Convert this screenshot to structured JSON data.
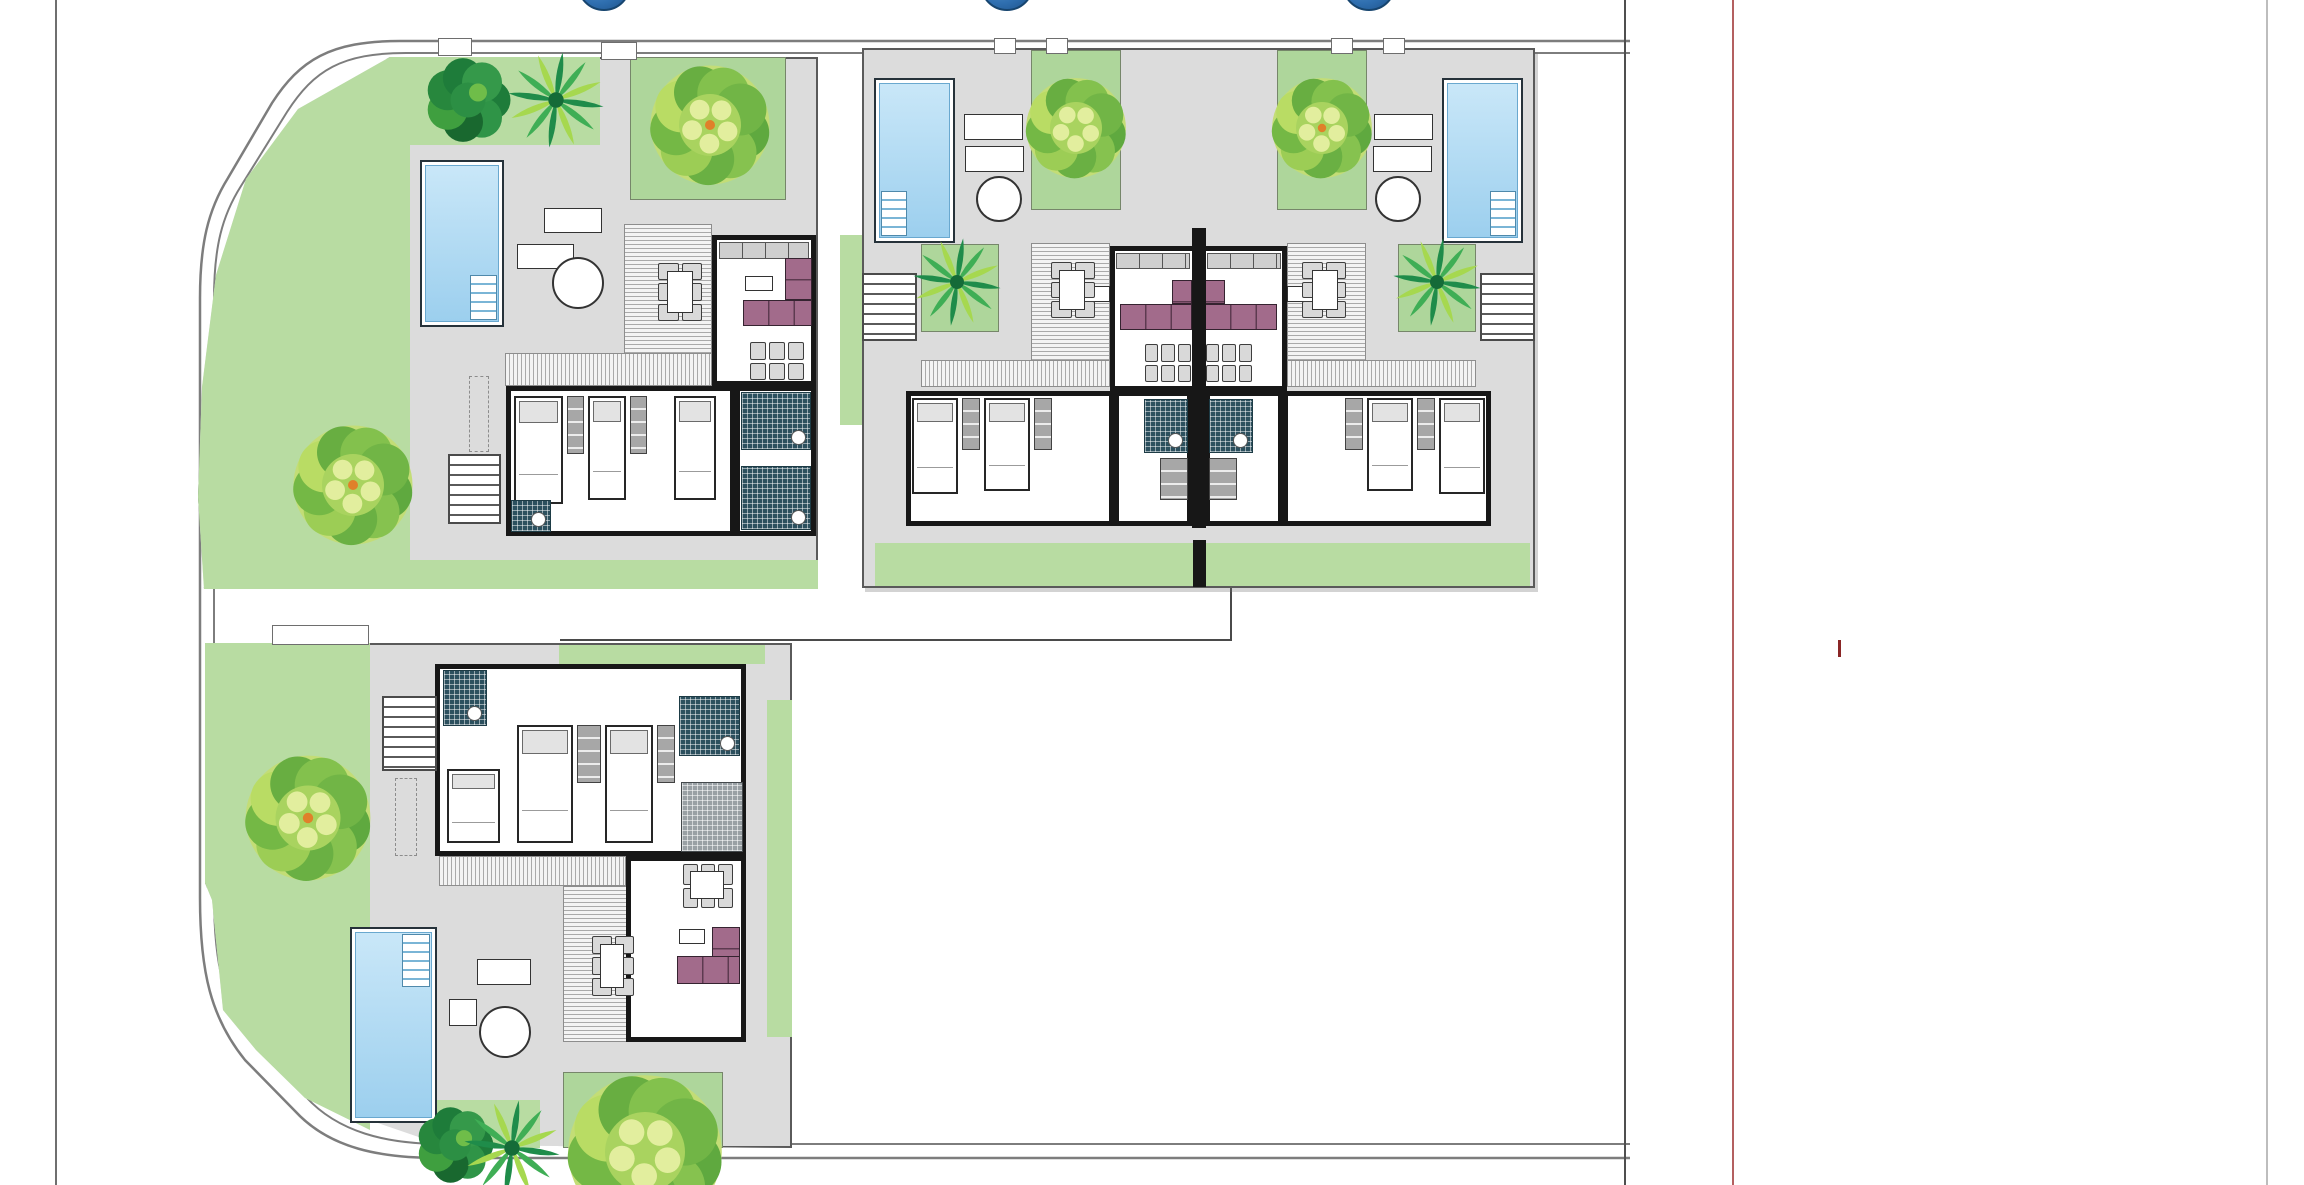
{
  "meta": {
    "kind": "residential-site-plan",
    "description": "Color site plan of four single-storey dwellings with private pools, gardens, trees and a curved perimeter road",
    "dwellings": [
      {
        "id": "villa-northwest",
        "bedrooms_visible": 3,
        "pool": true,
        "sun_loungers": 2,
        "outdoor_dining": true
      },
      {
        "id": "duplex-unit-west",
        "bedrooms_visible": 2,
        "pool": true,
        "sun_loungers": 2,
        "outdoor_dining": true
      },
      {
        "id": "duplex-unit-east",
        "bedrooms_visible": 2,
        "pool": true,
        "sun_loungers": 2,
        "outdoor_dining": true
      },
      {
        "id": "villa-south",
        "bedrooms_visible": 3,
        "pool": true,
        "sun_loungers": 1,
        "outdoor_dining": true
      }
    ]
  },
  "palette": {
    "paper": "#ffffff",
    "plotGray": "#dcdcdc",
    "plotBorder": "#5a5a5a",
    "lawn": "#b8dca2",
    "lawnB": "#aed69b",
    "pool": "#9ccfee",
    "poolLight": "#c9e7f8",
    "wall": "#171717",
    "sofa": "#a26b8b",
    "tile": "#2c505e",
    "road": "#7d7d7d",
    "marker": "#2f6fb0",
    "redline": "#b46060",
    "redtick": "#8a2626"
  },
  "road": {
    "outer": "M1630,41 H400 C330,41 300,60 272,103 L228,178 C208,210 200,244 200,298 V898 C200,972 211,1018 245,1060 L295,1111 C330,1149 381,1158 440,1158 H1630",
    "inner": "M1630,53 H406 C342,53 314,70 287,112 L241,186 C222,216 214,247 214,299 V896 C214,966 224,1008 257,1049 L306,1097 C338,1132 386,1144 442,1144 H1630"
  },
  "frame_lines": [
    {
      "n": "page-edge-left",
      "x": 55,
      "w": 2,
      "c": "#6f6f6f"
    },
    {
      "n": "parcel-line",
      "x": 1624,
      "w": 2,
      "c": "#4f4f4f"
    },
    {
      "n": "red-boundary-line",
      "x": 1732,
      "w": 2,
      "c": "#b46060"
    },
    {
      "n": "page-edge-right",
      "x": 2266,
      "w": 2,
      "c": "#bdbdbd"
    }
  ],
  "red_tick": {
    "x": 1838,
    "y": 640,
    "w": 3,
    "h": 17,
    "c": "#8a2626"
  },
  "markers": {
    "r": 27,
    "cy": -16,
    "items": [
      {
        "x": 604
      },
      {
        "x": 1007
      },
      {
        "x": 1369
      }
    ]
  },
  "plots": [
    {
      "n": "plot-northwest",
      "x": 198,
      "y": 57,
      "w": 620,
      "h": 532,
      "clip": "192,0 620,0 620,532 6,532 0,440 4,330 18,218 48,122 100,52"
    },
    {
      "n": "plot-duplex",
      "x": 862,
      "y": 48,
      "w": 673,
      "h": 540
    },
    {
      "n": "plot-south",
      "x": 205,
      "y": 643,
      "w": 587,
      "h": 505,
      "clip": "0,0 587,0 587,505 237,502 100,455 51,407 18,367 7,257 0,240"
    }
  ],
  "boundary_lines": [
    {
      "n": "fence-line-h",
      "x": 560,
      "y": 639,
      "w": 671,
      "h": 2,
      "c": "#4a4a4a"
    },
    {
      "n": "fence-line-v",
      "x": 1230,
      "y": 588,
      "w": 2,
      "h": 53,
      "c": "#4a4a4a"
    }
  ],
  "elements": [
    {
      "t": "lawn",
      "n": "garden-west",
      "x": 198,
      "y": 57,
      "w": 212,
      "h": 532,
      "clip": "192,0 212,0 212,532 6,532 0,440 4,330 18,218 48,122 100,52"
    },
    {
      "t": "lawn",
      "n": "garden-north-strip",
      "x": 406,
      "y": 57,
      "w": 194,
      "h": 88
    },
    {
      "t": "lawnb",
      "n": "garden-plot-ne",
      "x": 630,
      "y": 57,
      "w": 156,
      "h": 143
    },
    {
      "t": "lawn",
      "n": "garden-south-strip",
      "x": 395,
      "y": 560,
      "w": 423,
      "h": 29
    },
    {
      "t": "lawn",
      "n": "garden-gap-strip",
      "x": 840,
      "y": 235,
      "w": 22,
      "h": 190
    },
    {
      "t": "lawn",
      "n": "garden-duplex-south",
      "x": 875,
      "y": 543,
      "w": 655,
      "h": 43
    },
    {
      "t": "lawnb",
      "n": "garden-duplex-w",
      "x": 1031,
      "y": 50,
      "w": 90,
      "h": 160
    },
    {
      "t": "lawnb",
      "n": "courtyard-duplex-w",
      "x": 921,
      "y": 244,
      "w": 78,
      "h": 88
    },
    {
      "t": "lawnb",
      "n": "garden-duplex-e",
      "x": 1277,
      "y": 50,
      "w": 90,
      "h": 160
    },
    {
      "t": "lawnb",
      "n": "courtyard-duplex-e",
      "x": 1398,
      "y": 244,
      "w": 78,
      "h": 88
    },
    {
      "t": "lawn",
      "n": "garden-south-west",
      "x": 205,
      "y": 643,
      "w": 165,
      "h": 505,
      "clip": "0,0 165,0 165,487 100,455 51,407 18,367 7,257 0,240"
    },
    {
      "t": "lawn",
      "n": "garden-south-top",
      "x": 559,
      "y": 645,
      "w": 206,
      "h": 19
    },
    {
      "t": "lawn",
      "n": "garden-south-col",
      "x": 767,
      "y": 700,
      "w": 25,
      "h": 337
    },
    {
      "t": "lawnb",
      "n": "garden-south-se",
      "x": 563,
      "y": 1072,
      "w": 160,
      "h": 76
    },
    {
      "t": "lawn",
      "n": "garden-south-bottom",
      "x": 435,
      "y": 1100,
      "w": 105,
      "h": 48
    },
    {
      "t": "gate",
      "x": 438,
      "y": 38,
      "w": 34,
      "h": 18
    },
    {
      "t": "gate",
      "x": 601,
      "y": 42,
      "w": 36,
      "h": 18
    },
    {
      "t": "gate",
      "x": 994,
      "y": 38,
      "w": 22,
      "h": 16
    },
    {
      "t": "gate",
      "x": 1046,
      "y": 38,
      "w": 22,
      "h": 16
    },
    {
      "t": "gate",
      "x": 1331,
      "y": 38,
      "w": 22,
      "h": 16
    },
    {
      "t": "gate",
      "x": 1383,
      "y": 38,
      "w": 22,
      "h": 16
    },
    {
      "t": "gate",
      "x": 272,
      "y": 625,
      "w": 97,
      "h": 20
    },
    {
      "t": "pool",
      "x": 420,
      "y": 160,
      "w": 84,
      "h": 167,
      "steps": "br"
    },
    {
      "t": "pool",
      "x": 874,
      "y": 78,
      "w": 81,
      "h": 165,
      "steps": "bl"
    },
    {
      "t": "pool",
      "x": 1442,
      "y": 78,
      "w": 81,
      "h": 165,
      "steps": "br"
    },
    {
      "t": "pool",
      "x": 350,
      "y": 927,
      "w": 87,
      "h": 196,
      "steps": "tr"
    },
    {
      "t": "lounger",
      "x": 544,
      "y": 208,
      "w": 58,
      "h": 25
    },
    {
      "t": "lounger",
      "x": 517,
      "y": 244,
      "w": 57,
      "h": 25
    },
    {
      "t": "roundtable",
      "x": 552,
      "y": 257,
      "w": 52,
      "h": 52
    },
    {
      "t": "lounger",
      "x": 964,
      "y": 114,
      "w": 59,
      "h": 26
    },
    {
      "t": "lounger",
      "x": 965,
      "y": 146,
      "w": 59,
      "h": 26
    },
    {
      "t": "roundtable",
      "x": 976,
      "y": 176,
      "w": 46,
      "h": 46
    },
    {
      "t": "lounger",
      "x": 1374,
      "y": 114,
      "w": 59,
      "h": 26
    },
    {
      "t": "lounger",
      "x": 1373,
      "y": 146,
      "w": 59,
      "h": 26
    },
    {
      "t": "roundtable",
      "x": 1375,
      "y": 176,
      "w": 46,
      "h": 46
    },
    {
      "t": "lounger",
      "x": 477,
      "y": 959,
      "w": 54,
      "h": 26
    },
    {
      "t": "wtable",
      "x": 449,
      "y": 999,
      "w": 28,
      "h": 27
    },
    {
      "t": "roundtable",
      "x": 479,
      "y": 1006,
      "w": 52,
      "h": 52
    },
    {
      "t": "deck",
      "dir": "h",
      "x": 624,
      "y": 224,
      "w": 88,
      "h": 131
    },
    {
      "t": "deck",
      "dir": "v",
      "x": 505,
      "y": 353,
      "w": 207,
      "h": 33
    },
    {
      "t": "deck",
      "dir": "h",
      "x": 1031,
      "y": 243,
      "w": 79,
      "h": 120
    },
    {
      "t": "deck",
      "dir": "v",
      "x": 921,
      "y": 360,
      "w": 189,
      "h": 27
    },
    {
      "t": "deck",
      "dir": "h",
      "x": 1287,
      "y": 243,
      "w": 79,
      "h": 120
    },
    {
      "t": "deck",
      "dir": "v",
      "x": 1287,
      "y": 360,
      "w": 189,
      "h": 27
    },
    {
      "t": "deck",
      "dir": "v",
      "x": 439,
      "y": 856,
      "w": 187,
      "h": 30
    },
    {
      "t": "deck",
      "dir": "h",
      "x": 563,
      "y": 886,
      "w": 122,
      "h": 156
    },
    {
      "t": "room",
      "n": "living-room-nw",
      "x": 712,
      "y": 235,
      "w": 104,
      "h": 151
    },
    {
      "t": "room",
      "n": "bedroom-wing-nw",
      "x": 506,
      "y": 386,
      "w": 229,
      "h": 150
    },
    {
      "t": "room",
      "n": "bath-block-nw",
      "x": 735,
      "y": 386,
      "w": 81,
      "h": 150
    },
    {
      "t": "room",
      "n": "living-room-duplex-w",
      "x": 1110,
      "y": 246,
      "w": 88,
      "h": 145
    },
    {
      "t": "room",
      "n": "bedroom-wing-duplex-w",
      "x": 906,
      "y": 391,
      "w": 208,
      "h": 135
    },
    {
      "t": "room",
      "n": "bath-block-duplex-w",
      "x": 1114,
      "y": 391,
      "w": 78,
      "h": 135
    },
    {
      "t": "room",
      "n": "living-room-duplex-e",
      "x": 1199,
      "y": 246,
      "w": 88,
      "h": 145
    },
    {
      "t": "room",
      "n": "bedroom-wing-duplex-e",
      "x": 1283,
      "y": 391,
      "w": 208,
      "h": 135
    },
    {
      "t": "room",
      "n": "bath-block-duplex-e",
      "x": 1205,
      "y": 391,
      "w": 78,
      "h": 135
    },
    {
      "t": "room",
      "n": "bedroom-wing-s",
      "x": 435,
      "y": 664,
      "w": 311,
      "h": 192
    },
    {
      "t": "room",
      "n": "living-room-s",
      "x": 626,
      "y": 856,
      "w": 120,
      "h": 186
    },
    {
      "t": "counter",
      "x": 719,
      "y": 242,
      "w": 90,
      "h": 17
    },
    {
      "t": "sofa",
      "x": 743,
      "y": 300,
      "w": 69,
      "h": 26
    },
    {
      "t": "sofa",
      "cls": "v",
      "x": 785,
      "y": 258,
      "w": 27,
      "h": 42
    },
    {
      "t": "wtable",
      "x": 745,
      "y": 276,
      "w": 28,
      "h": 15
    },
    {
      "t": "chairs",
      "x": 750,
      "y": 342,
      "w": 54,
      "h": 38,
      "cols": 3,
      "rows": 2
    },
    {
      "t": "chairs",
      "x": 658,
      "y": 263,
      "w": 44,
      "h": 58,
      "cols": 2,
      "rows": 3
    },
    {
      "t": "wtable",
      "x": 667,
      "y": 271,
      "w": 26,
      "h": 42
    },
    {
      "t": "bed",
      "x": 514,
      "y": 396,
      "w": 49,
      "h": 108
    },
    {
      "t": "closet",
      "x": 567,
      "y": 396,
      "w": 17,
      "h": 58
    },
    {
      "t": "bed",
      "x": 588,
      "y": 396,
      "w": 38,
      "h": 104
    },
    {
      "t": "closet",
      "x": 630,
      "y": 396,
      "w": 17,
      "h": 58
    },
    {
      "t": "bed",
      "x": 674,
      "y": 396,
      "w": 42,
      "h": 104
    },
    {
      "t": "tile",
      "x": 741,
      "y": 392,
      "w": 70,
      "h": 58
    },
    {
      "t": "tile",
      "x": 741,
      "y": 466,
      "w": 70,
      "h": 64
    },
    {
      "t": "tile",
      "x": 511,
      "y": 500,
      "w": 40,
      "h": 32
    },
    {
      "t": "stairs",
      "dir": "v",
      "x": 448,
      "y": 454,
      "w": 53,
      "h": 70
    },
    {
      "t": "dash",
      "x": 469,
      "y": 376,
      "w": 20,
      "h": 76
    },
    {
      "t": "counter",
      "x": 1116,
      "y": 253,
      "w": 74,
      "h": 16
    },
    {
      "t": "sofa",
      "x": 1120,
      "y": 304,
      "w": 72,
      "h": 26
    },
    {
      "t": "sofa",
      "cls": "v",
      "x": 1172,
      "y": 280,
      "w": 20,
      "h": 24
    },
    {
      "t": "wtable",
      "x": 1068,
      "y": 286,
      "w": 42,
      "h": 16
    },
    {
      "t": "chairs",
      "x": 1145,
      "y": 344,
      "w": 46,
      "h": 38,
      "cols": 3,
      "rows": 2
    },
    {
      "t": "chairs",
      "x": 1051,
      "y": 262,
      "w": 44,
      "h": 56,
      "cols": 2,
      "rows": 3
    },
    {
      "t": "wtable",
      "x": 1059,
      "y": 270,
      "w": 26,
      "h": 40
    },
    {
      "t": "bed",
      "x": 912,
      "y": 398,
      "w": 46,
      "h": 96
    },
    {
      "t": "closet",
      "x": 962,
      "y": 398,
      "w": 18,
      "h": 52
    },
    {
      "t": "bed",
      "x": 984,
      "y": 398,
      "w": 46,
      "h": 93
    },
    {
      "t": "closet",
      "x": 1034,
      "y": 398,
      "w": 18,
      "h": 52
    },
    {
      "t": "tile",
      "x": 1144,
      "y": 399,
      "w": 44,
      "h": 54
    },
    {
      "t": "closet",
      "x": 1160,
      "y": 458,
      "w": 28,
      "h": 42
    },
    {
      "t": "stairs",
      "dir": "v",
      "x": 862,
      "y": 273,
      "w": 55,
      "h": 68
    },
    {
      "t": "counter",
      "x": 1207,
      "y": 253,
      "w": 74,
      "h": 16
    },
    {
      "t": "sofa",
      "x": 1205,
      "y": 304,
      "w": 72,
      "h": 26
    },
    {
      "t": "sofa",
      "cls": "v",
      "x": 1205,
      "y": 280,
      "w": 20,
      "h": 24
    },
    {
      "t": "wtable",
      "x": 1287,
      "y": 286,
      "w": 42,
      "h": 16
    },
    {
      "t": "chairs",
      "x": 1206,
      "y": 344,
      "w": 46,
      "h": 38,
      "cols": 3,
      "rows": 2
    },
    {
      "t": "chairs",
      "x": 1302,
      "y": 262,
      "w": 44,
      "h": 56,
      "cols": 2,
      "rows": 3
    },
    {
      "t": "wtable",
      "x": 1312,
      "y": 270,
      "w": 26,
      "h": 40
    },
    {
      "t": "bed",
      "x": 1439,
      "y": 398,
      "w": 46,
      "h": 96
    },
    {
      "t": "closet",
      "x": 1417,
      "y": 398,
      "w": 18,
      "h": 52
    },
    {
      "t": "bed",
      "x": 1367,
      "y": 398,
      "w": 46,
      "h": 93
    },
    {
      "t": "closet",
      "x": 1345,
      "y": 398,
      "w": 18,
      "h": 52
    },
    {
      "t": "tile",
      "x": 1209,
      "y": 399,
      "w": 44,
      "h": 54
    },
    {
      "t": "closet",
      "x": 1209,
      "y": 458,
      "w": 28,
      "h": 42
    },
    {
      "t": "stairs",
      "dir": "v",
      "x": 1480,
      "y": 273,
      "w": 55,
      "h": 68
    },
    {
      "t": "wall",
      "x": 1192,
      "y": 228,
      "w": 14,
      "h": 300
    },
    {
      "t": "wall",
      "x": 1193,
      "y": 540,
      "w": 13,
      "h": 47
    },
    {
      "t": "tile",
      "x": 443,
      "y": 670,
      "w": 44,
      "h": 56
    },
    {
      "t": "bed",
      "x": 447,
      "y": 769,
      "w": 53,
      "h": 74
    },
    {
      "t": "bed",
      "x": 517,
      "y": 725,
      "w": 56,
      "h": 118
    },
    {
      "t": "closet",
      "x": 577,
      "y": 725,
      "w": 24,
      "h": 58
    },
    {
      "t": "bed",
      "x": 605,
      "y": 725,
      "w": 48,
      "h": 118
    },
    {
      "t": "closet",
      "x": 657,
      "y": 725,
      "w": 18,
      "h": 58
    },
    {
      "t": "tile",
      "x": 679,
      "y": 696,
      "w": 61,
      "h": 60
    },
    {
      "t": "ktile",
      "x": 681,
      "y": 782,
      "w": 62,
      "h": 70
    },
    {
      "t": "chairs",
      "x": 683,
      "y": 864,
      "w": 50,
      "h": 44,
      "cols": 3,
      "rows": 2
    },
    {
      "t": "wtable",
      "x": 690,
      "y": 871,
      "w": 34,
      "h": 28
    },
    {
      "t": "sofa",
      "cls": "v",
      "x": 712,
      "y": 927,
      "w": 28,
      "h": 57
    },
    {
      "t": "sofa",
      "x": 677,
      "y": 956,
      "w": 63,
      "h": 28
    },
    {
      "t": "wtable",
      "x": 679,
      "y": 929,
      "w": 26,
      "h": 15
    },
    {
      "t": "chairs",
      "x": 592,
      "y": 936,
      "w": 42,
      "h": 60,
      "cols": 2,
      "rows": 3
    },
    {
      "t": "wtable",
      "x": 600,
      "y": 944,
      "w": 24,
      "h": 44
    },
    {
      "t": "stairs",
      "dir": "v",
      "x": 382,
      "y": 696,
      "w": 55,
      "h": 75
    },
    {
      "t": "dash",
      "x": 395,
      "y": 778,
      "w": 22,
      "h": 78
    },
    {
      "t": "bush",
      "cx": 468,
      "cy": 100,
      "r": 50
    },
    {
      "t": "palm",
      "cx": 556,
      "cy": 100,
      "r": 48
    },
    {
      "t": "tree",
      "cx": 710,
      "cy": 125,
      "r": 62,
      "dot": true
    },
    {
      "t": "tree",
      "cx": 353,
      "cy": 485,
      "r": 62,
      "dot": true
    },
    {
      "t": "tree",
      "cx": 1076,
      "cy": 128,
      "r": 52
    },
    {
      "t": "tree",
      "cx": 1322,
      "cy": 128,
      "r": 52,
      "dot": true
    },
    {
      "t": "palm",
      "cx": 957,
      "cy": 282,
      "r": 44
    },
    {
      "t": "palm",
      "cx": 1437,
      "cy": 282,
      "r": 44
    },
    {
      "t": "tree",
      "cx": 308,
      "cy": 818,
      "r": 65,
      "dot": true
    },
    {
      "t": "bush",
      "cx": 455,
      "cy": 1145,
      "r": 45
    },
    {
      "t": "palm",
      "cx": 512,
      "cy": 1148,
      "r": 48
    },
    {
      "t": "tree",
      "cx": 645,
      "cy": 1152,
      "r": 80
    }
  ]
}
